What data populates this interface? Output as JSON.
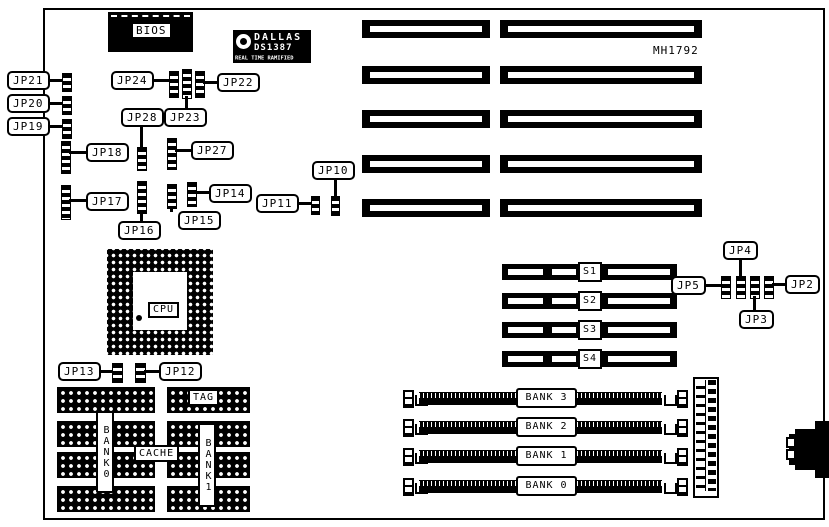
{
  "board": {
    "model": "MH1792"
  },
  "colors": {
    "ink": "#000000",
    "paper": "#ffffff"
  },
  "icons": {
    "dallas_logo": "alarm-clock"
  },
  "chips": {
    "bios": "BIOS",
    "cpu": "CPU",
    "cache": "CACHE",
    "tag": "TAG",
    "cache_bank_left": "BANK0",
    "cache_bank_right": "BANK1"
  },
  "dallas": {
    "brand": "DALLAS",
    "part": "DS1387",
    "subtitle": "REAL TIME RAMIFIED"
  },
  "jumpers": {
    "jp2": "JP2",
    "jp3": "JP3",
    "jp4": "JP4",
    "jp5": "JP5",
    "jp10": "JP10",
    "jp11": "JP11",
    "jp12": "JP12",
    "jp13": "JP13",
    "jp14": "JP14",
    "jp15": "JP15",
    "jp16": "JP16",
    "jp17": "JP17",
    "jp18": "JP18",
    "jp19": "JP19",
    "jp20": "JP20",
    "jp21": "JP21",
    "jp22": "JP22",
    "jp23": "JP23",
    "jp24": "JP24",
    "jp27": "JP27",
    "jp28": "JP28"
  },
  "sipp_slots": [
    "S1",
    "S2",
    "S3",
    "S4"
  ],
  "simm_banks": [
    "BANK 3",
    "BANK 2",
    "BANK 1",
    "BANK 0"
  ]
}
